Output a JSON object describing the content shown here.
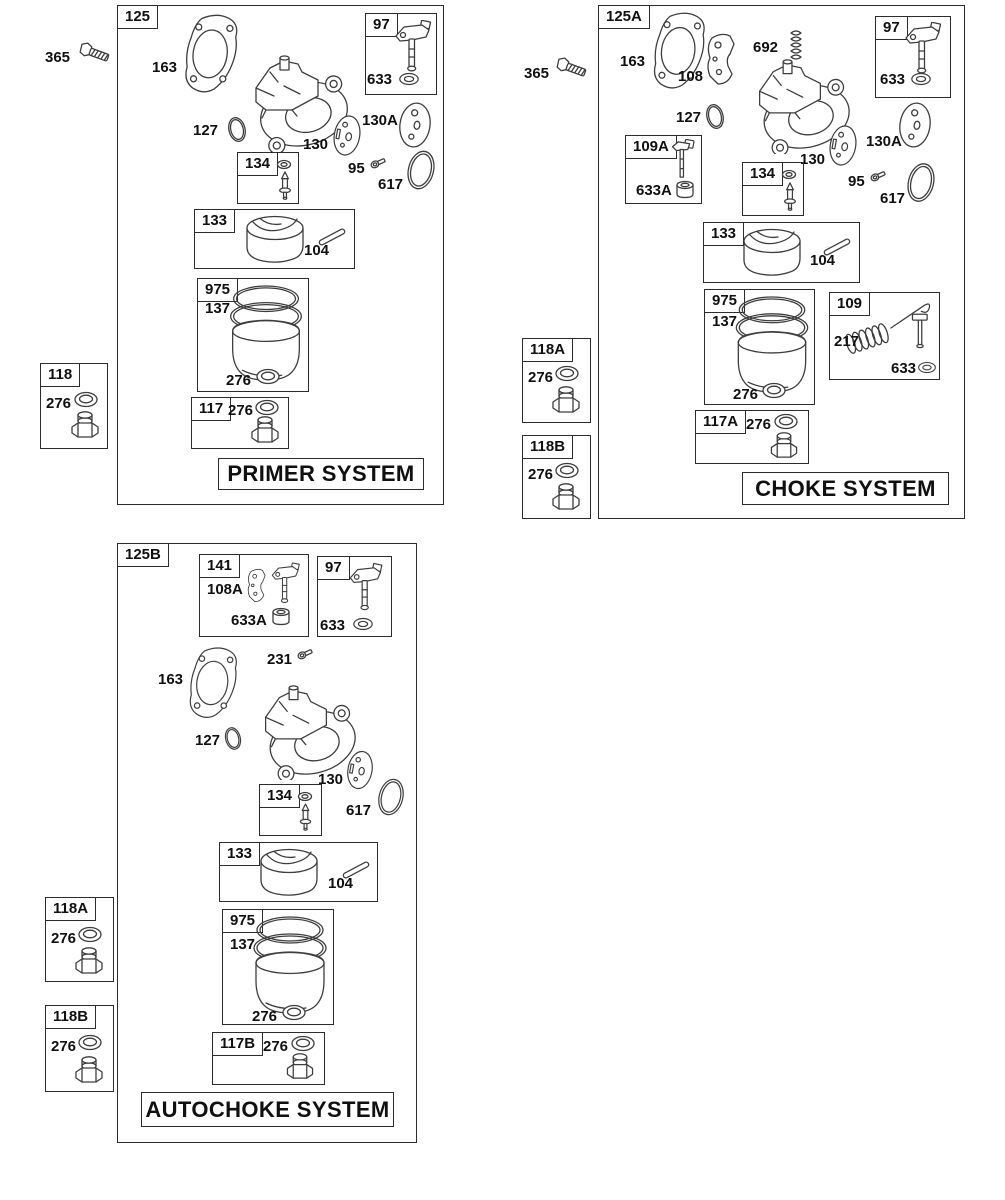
{
  "primer": {
    "box": "125",
    "title": "PRIMER SYSTEM",
    "mount_screw": "365",
    "gasket": "163",
    "throttle_kit": "97",
    "seal": "633",
    "body_oring": "127",
    "throttle_plate": "130",
    "choke_plate": "130A",
    "needle_kit": "134",
    "idle_screw": "95",
    "bowl_oring": "617",
    "float_kit": "133",
    "float_pin": "104",
    "bowl_kit": "975",
    "bowl_gasket": "137",
    "washer": "276",
    "nut_kit": "117",
    "fastener_kit": "118"
  },
  "choke": {
    "box": "125A",
    "title": "CHOKE SYSTEM",
    "mount_screw": "365",
    "gasket": "163",
    "choke_shaft_plate": "108",
    "choke_spring": "692",
    "throttle_kit": "97",
    "seal": "633",
    "body_oring": "127",
    "thermostat_kit": "109A",
    "bushing": "633A",
    "throttle_plate": "130",
    "choke_plate": "130A",
    "needle_kit": "134",
    "idle_screw": "95",
    "bowl_oring": "617",
    "float_kit": "133",
    "float_pin": "104",
    "bowl_kit": "975",
    "bowl_gasket": "137",
    "washer": "276",
    "link_kit": "109",
    "link_spring": "217",
    "link_seal": "633",
    "nut_kit": "117A",
    "fastener_kit_a": "118A",
    "fastener_kit_b": "118B"
  },
  "autochoke": {
    "box": "125B",
    "title": "AUTOCHOKE SYSTEM",
    "shaft_kit": "141",
    "shaft_plate": "108A",
    "bushing": "633A",
    "throttle_kit": "97",
    "seal": "633",
    "plate_screw": "231",
    "gasket": "163",
    "body_oring": "127",
    "throttle_plate": "130",
    "needle_kit": "134",
    "bowl_oring": "617",
    "float_kit": "133",
    "float_pin": "104",
    "bowl_kit": "975",
    "bowl_gasket": "137",
    "washer": "276",
    "nut_kit": "117B",
    "fastener_kit_a": "118A",
    "fastener_kit_b": "118B"
  }
}
